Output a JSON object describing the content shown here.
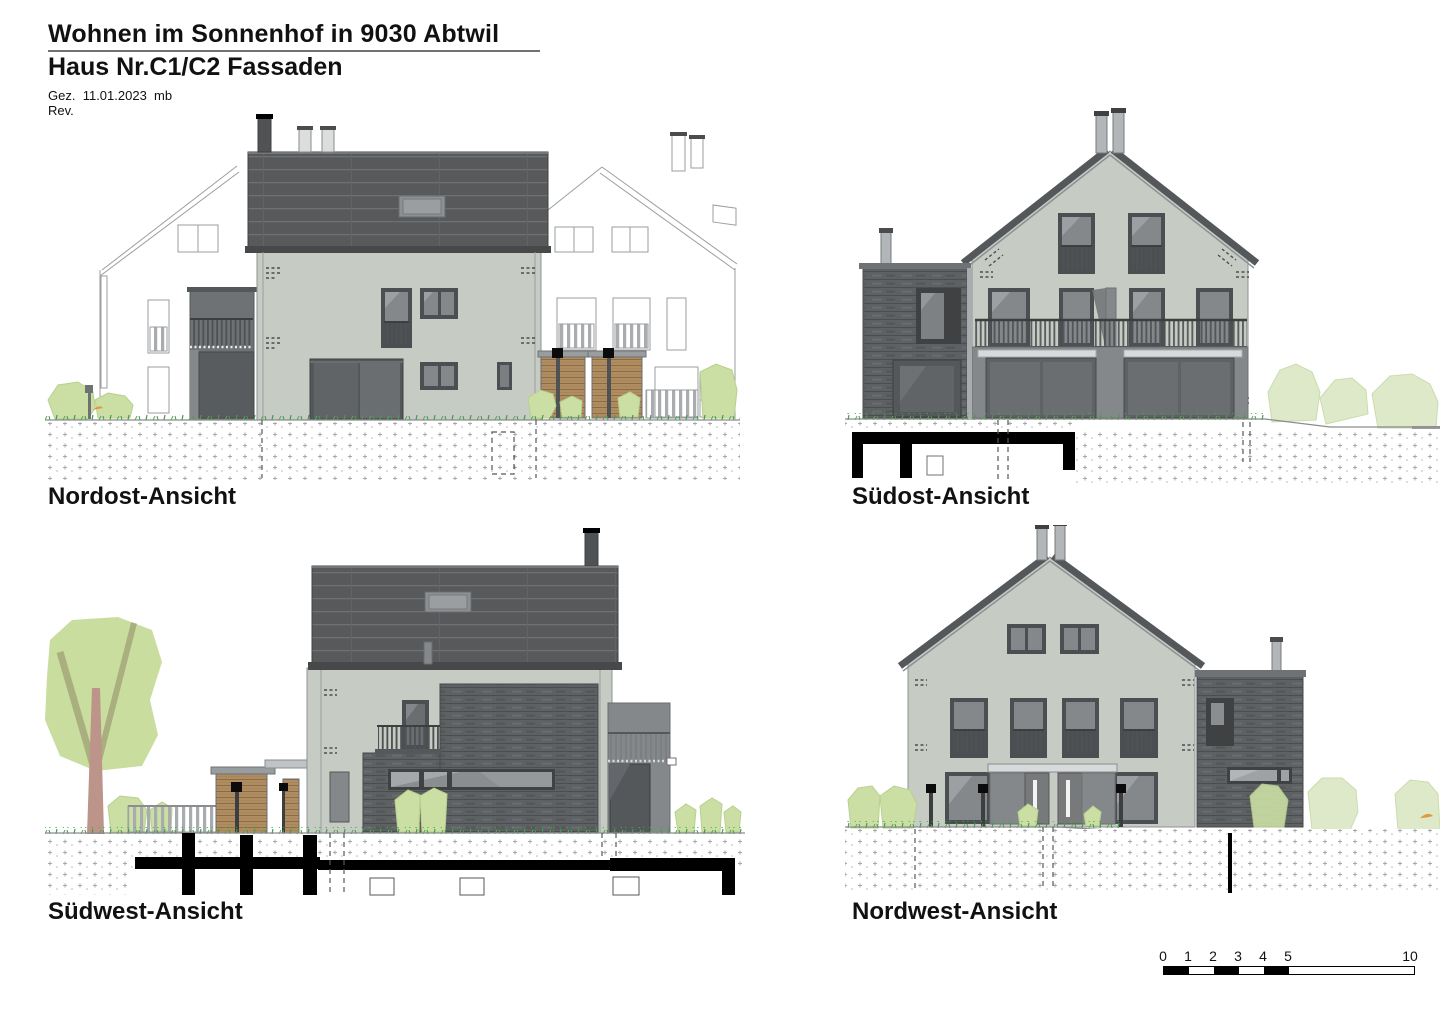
{
  "header": {
    "title": "Wohnen im Sonnenhof in 9030 Abtwil",
    "subtitle": "Haus Nr.C1/C2 Fassaden",
    "drawn_label": "Gez.",
    "drawn_date": "11.01.2023",
    "drawn_by": "mb",
    "revision_label": "Rev."
  },
  "views": {
    "nordost": {
      "label": "Nordost-Ansicht"
    },
    "suedost": {
      "label": "Südost-Ansicht"
    },
    "suedwest": {
      "label": "Südwest-Ansicht"
    },
    "nordwest": {
      "label": "Nordwest-Ansicht"
    }
  },
  "scale_bar": {
    "labels": [
      "0",
      "1",
      "2",
      "3",
      "4",
      "5",
      "10"
    ],
    "units_total": 10,
    "filled_units": [
      0,
      2,
      4
    ]
  },
  "palette": {
    "facade_light": "#c6cbc4",
    "roof_dark": "#57595b",
    "shingle_dark": "#5e6163",
    "window_frame": "#4c4f51",
    "glass_grey": "#85888b",
    "glass_dark": "#6b6e70",
    "annex_grey": "#6f7274",
    "wood_brown": "#b08d60",
    "greenery_light": "#cbdfa4",
    "greenery_pale": "#dde9c8",
    "tree_trunk": "#bc9489",
    "branch_olive": "#a9af7e",
    "grass_green": "#3f9e45",
    "ground_mark": "#a6a8aa",
    "section_black": "#000000",
    "outline_grey": "#9b9d9f"
  }
}
